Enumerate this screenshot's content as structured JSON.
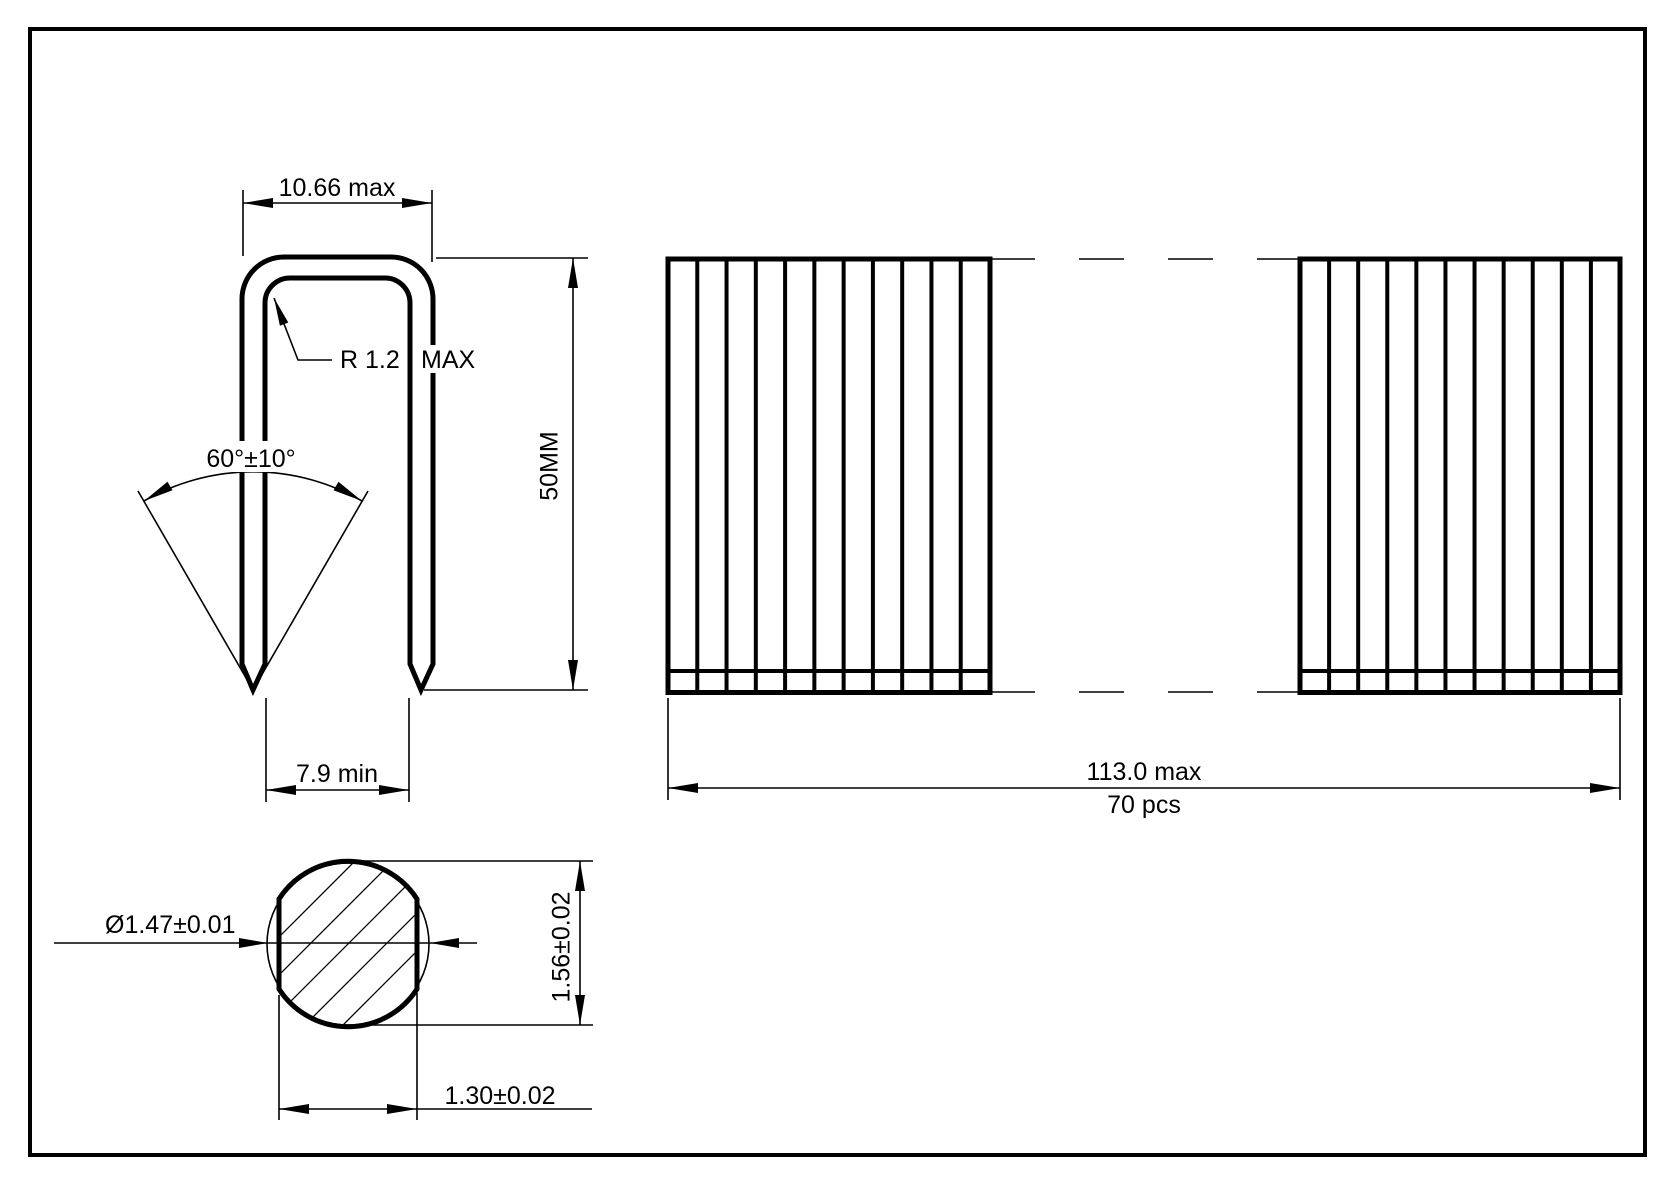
{
  "page": {
    "background": "#ffffff",
    "line_color": "#000000"
  },
  "profile_view": {
    "crown_width_dim": "10.66 max",
    "radius_value": "R 1.2",
    "radius_qualifier": "MAX",
    "point_angle_dim": "60°±10°",
    "leg_length_dim": "50MM",
    "inner_width_dim": "7.9 min"
  },
  "strip_view": {
    "staples_drawn_per_strip": 11,
    "strip_length_dim": "113.0 max",
    "piece_count": "70 pcs"
  },
  "cross_section_view": {
    "hatch_line_count": 7,
    "wire_diameter_dim": "Ø1.47±0.01",
    "flattened_height_dim": "1.56±0.02",
    "flattened_width_dim": "1.30±0.02"
  }
}
